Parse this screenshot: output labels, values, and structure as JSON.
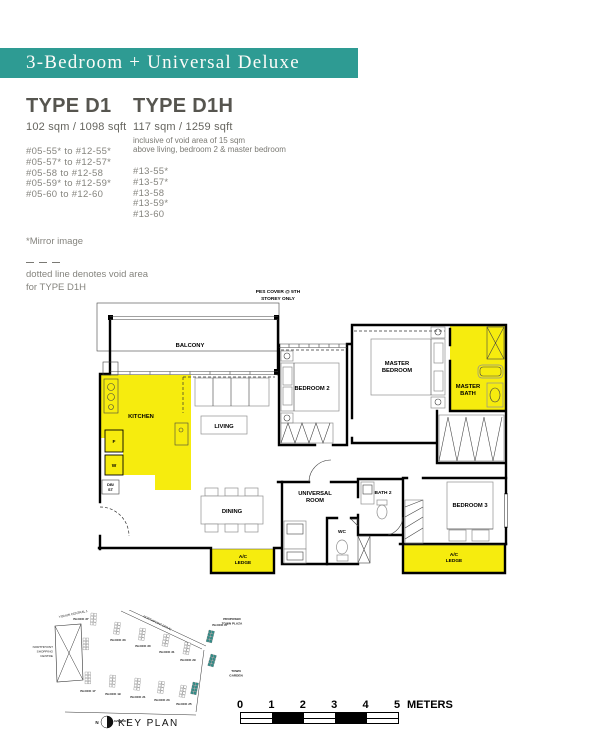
{
  "banner": {
    "title": "3-Bedroom + Universal Deluxe",
    "color": "#2E9B93"
  },
  "type_d1": {
    "name": "TYPE D1",
    "area": "102 sqm / 1098 sqft",
    "units": [
      "#05-55* to #12-55*",
      "#05-57* to #12-57*",
      "#05-58 to #12-58",
      "#05-59* to #12-59*",
      "#05-60 to #12-60"
    ]
  },
  "type_d1h": {
    "name": "TYPE D1H",
    "area": "117 sqm / 1259 sqft",
    "note": [
      "inclusive of void area of 15 sqm",
      "above living, bedroom 2 & master bedroom"
    ],
    "units": [
      "#13-55*",
      "#13-57*",
      "#13-58",
      "#13-59*",
      "#13-60"
    ]
  },
  "notes": {
    "mirror": "*Mirror image",
    "void": [
      "dotted line denotes void area",
      "for TYPE D1H"
    ]
  },
  "floorplan": {
    "pes": [
      "PES COVER @ 5TH",
      "STOREY ONLY"
    ],
    "balcony": "BALCONY",
    "kitchen": "KITCHEN",
    "fridge": "F",
    "washer": "W",
    "db": [
      "DB/",
      "ST"
    ],
    "living": "LIVING",
    "dining": "DINING",
    "bedroom2": "BEDROOM 2",
    "master_bedroom": [
      "MASTER",
      "BEDROOM"
    ],
    "master_bath": [
      "MASTER",
      "BATH"
    ],
    "universal": [
      "UNIVERSAL",
      "ROOM"
    ],
    "wc": "WC",
    "bath2": "BATH 2",
    "bedroom3": "BEDROOM 3",
    "ac_ledge": [
      "A/C",
      "LEDGE"
    ],
    "highlight_color": "#F6EC0E"
  },
  "keyplan": {
    "title": "KEY PLAN",
    "north": "N",
    "road_top": "YISHUN CENTRAL 1",
    "road_diag": "NORTHPOINT DRIVE",
    "road_bottom": "YISHUN AVENUE 2",
    "shopping": [
      "NORTHPOINT",
      "SHOPPING",
      "CENTRE"
    ],
    "plaza": [
      "PROPOSED",
      "TOWN PLAZA"
    ],
    "garden": [
      "TOWN",
      "GARDEN"
    ],
    "blocks": [
      "BLOCK 37",
      "BLOCK 33",
      "BLOCK 30",
      "BLOCK 31",
      "BLOCK 29",
      "BLOCK 27",
      "BLOCK 17",
      "BLOCK 19",
      "BLOCK 21",
      "BLOCK 23",
      "BLOCK 25"
    ],
    "highlight_color": "#2E8F8A"
  },
  "scalebar": {
    "ticks": [
      "0",
      "1",
      "2",
      "3",
      "4",
      "5"
    ],
    "unit": "METERS"
  }
}
